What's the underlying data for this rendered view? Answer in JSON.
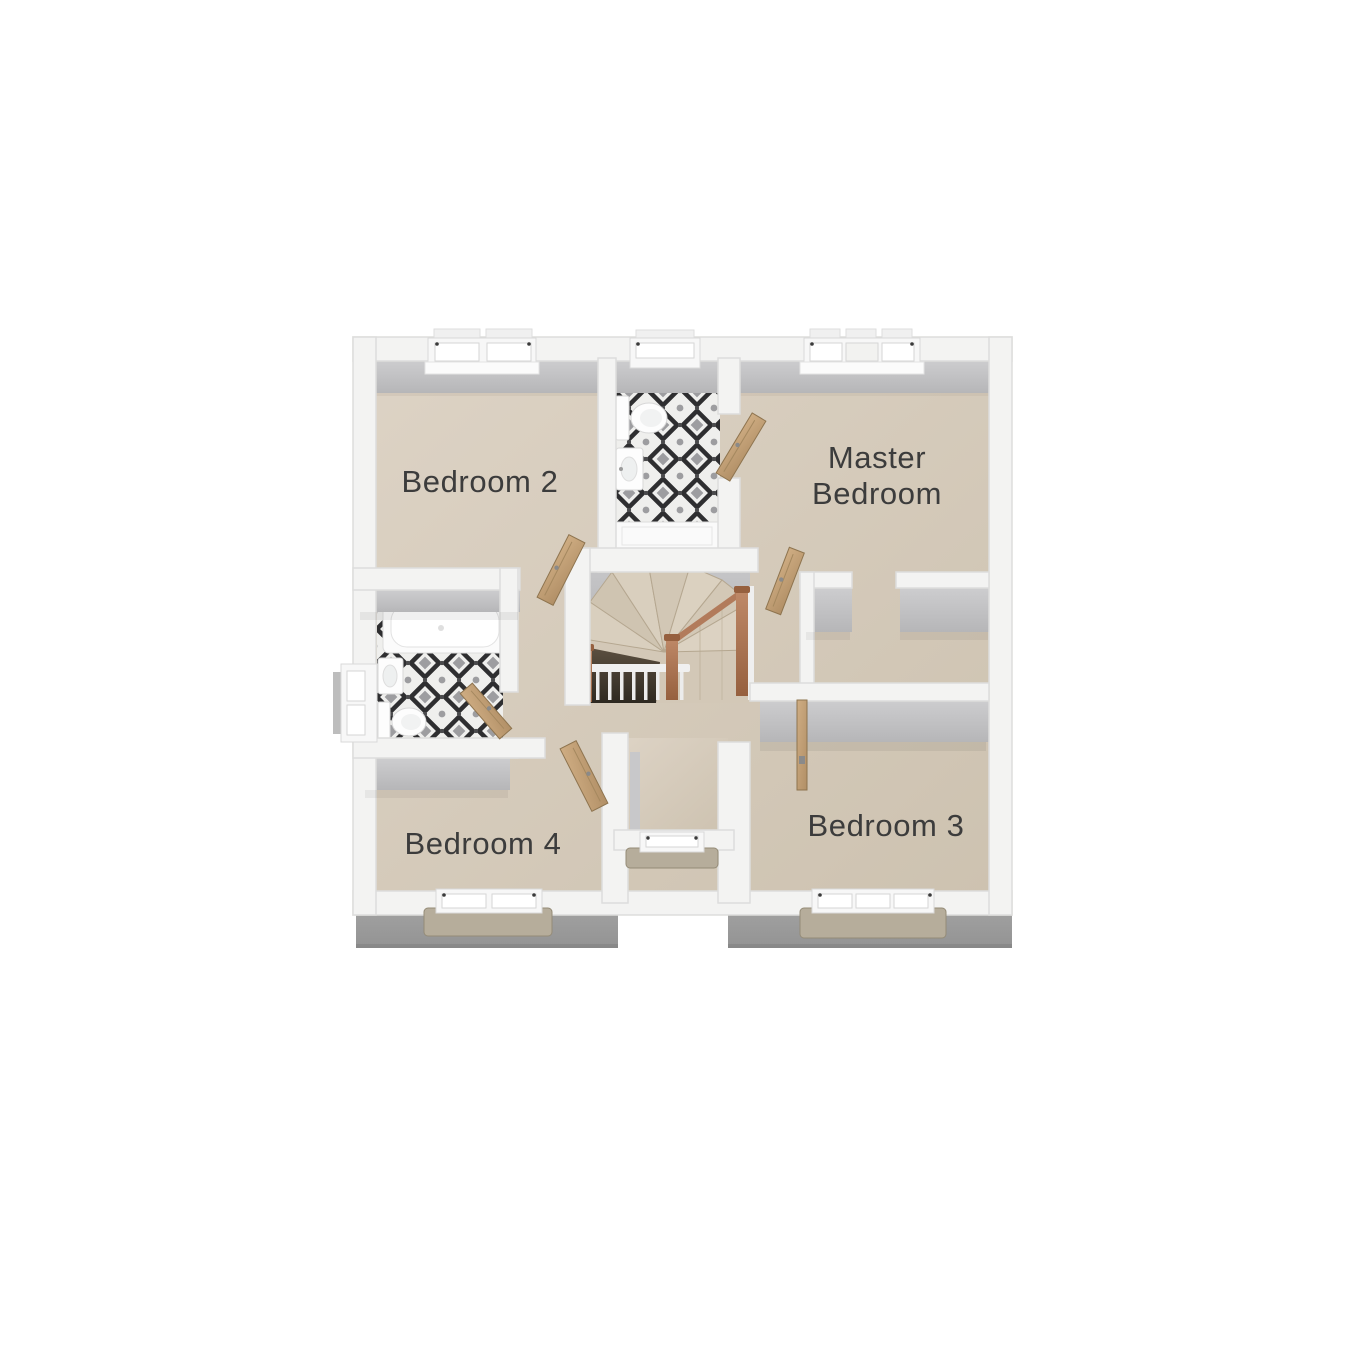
{
  "plan": {
    "type": "floor-plan",
    "floor": "first-floor",
    "rooms": {
      "bedroom2": {
        "label": "Bedroom 2"
      },
      "master": {
        "label": "Master Bedroom",
        "line1": "Master",
        "line2": "Bedroom"
      },
      "bedroom3": {
        "label": "Bedroom 3"
      },
      "bedroom4": {
        "label": "Bedroom 4"
      },
      "ensuite": {
        "label": ""
      },
      "bathroom": {
        "label": ""
      },
      "landing": {
        "label": ""
      }
    },
    "features": {
      "stairs": "central winder staircase with copper newels and white spindles",
      "ensuite_fixtures": [
        "toilet",
        "basin",
        "shower-tray"
      ],
      "bathroom_fixtures": [
        "bathtub",
        "basin",
        "toilet"
      ],
      "doors": [
        "bedroom2-door",
        "ensuite-door",
        "master-door",
        "bedroom4-door",
        "bathroom-door",
        "bedroom3-door"
      ],
      "windows": [
        "bedroom2-window",
        "ensuite-window",
        "master-window",
        "bathroom-window",
        "bedroom4-window",
        "landing-bay-window",
        "bedroom3-window"
      ]
    },
    "colors": {
      "background": "#ffffff",
      "wall": "#f3f3f2",
      "wall_face": "#c2c2c4",
      "floor": "#d8cec0",
      "tile_dark": "#2e2e30",
      "tile_gray": "#9d9da0",
      "door_wood": "#c5a478",
      "copper_newel": "#b27b5b",
      "exterior_roof": "#9e9e9e",
      "stone_sill": "#b6ad9b",
      "label_text": "#3c3c3c"
    }
  }
}
